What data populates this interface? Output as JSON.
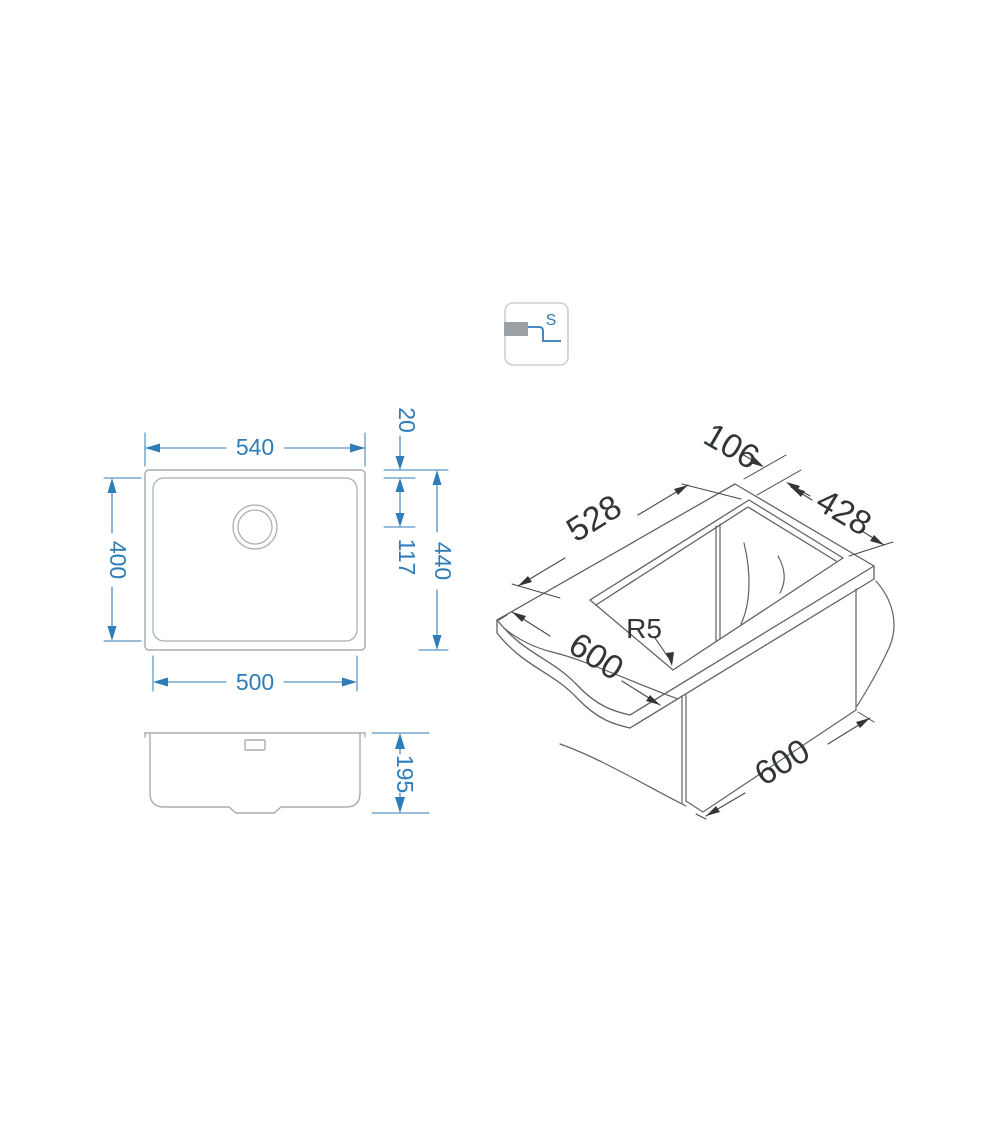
{
  "drawing_title": "undermount-sink-technical-drawing",
  "icon": {
    "letter": "S"
  },
  "colors": {
    "dimension_blue": "#2e7cb8",
    "outline_gray": "#a8adb0",
    "iso_line_gray": "#5f6367",
    "iso_text_dark": "#333639",
    "icon_border_gray": "#cbced0",
    "icon_fill_gray": "#9aa0a3"
  },
  "top_view": {
    "width_top": "540",
    "rim_offset": "20",
    "bowl_height": "400",
    "drain_offset": "117",
    "total_height": "440",
    "bowl_width": "500"
  },
  "side_view": {
    "depth": "195"
  },
  "iso_view": {
    "cutout_length": "528",
    "back_edge_offset": "106",
    "cutout_width": "428",
    "corner_radius": "R5",
    "worktop_depth": "600",
    "cabinet_width": "600"
  }
}
